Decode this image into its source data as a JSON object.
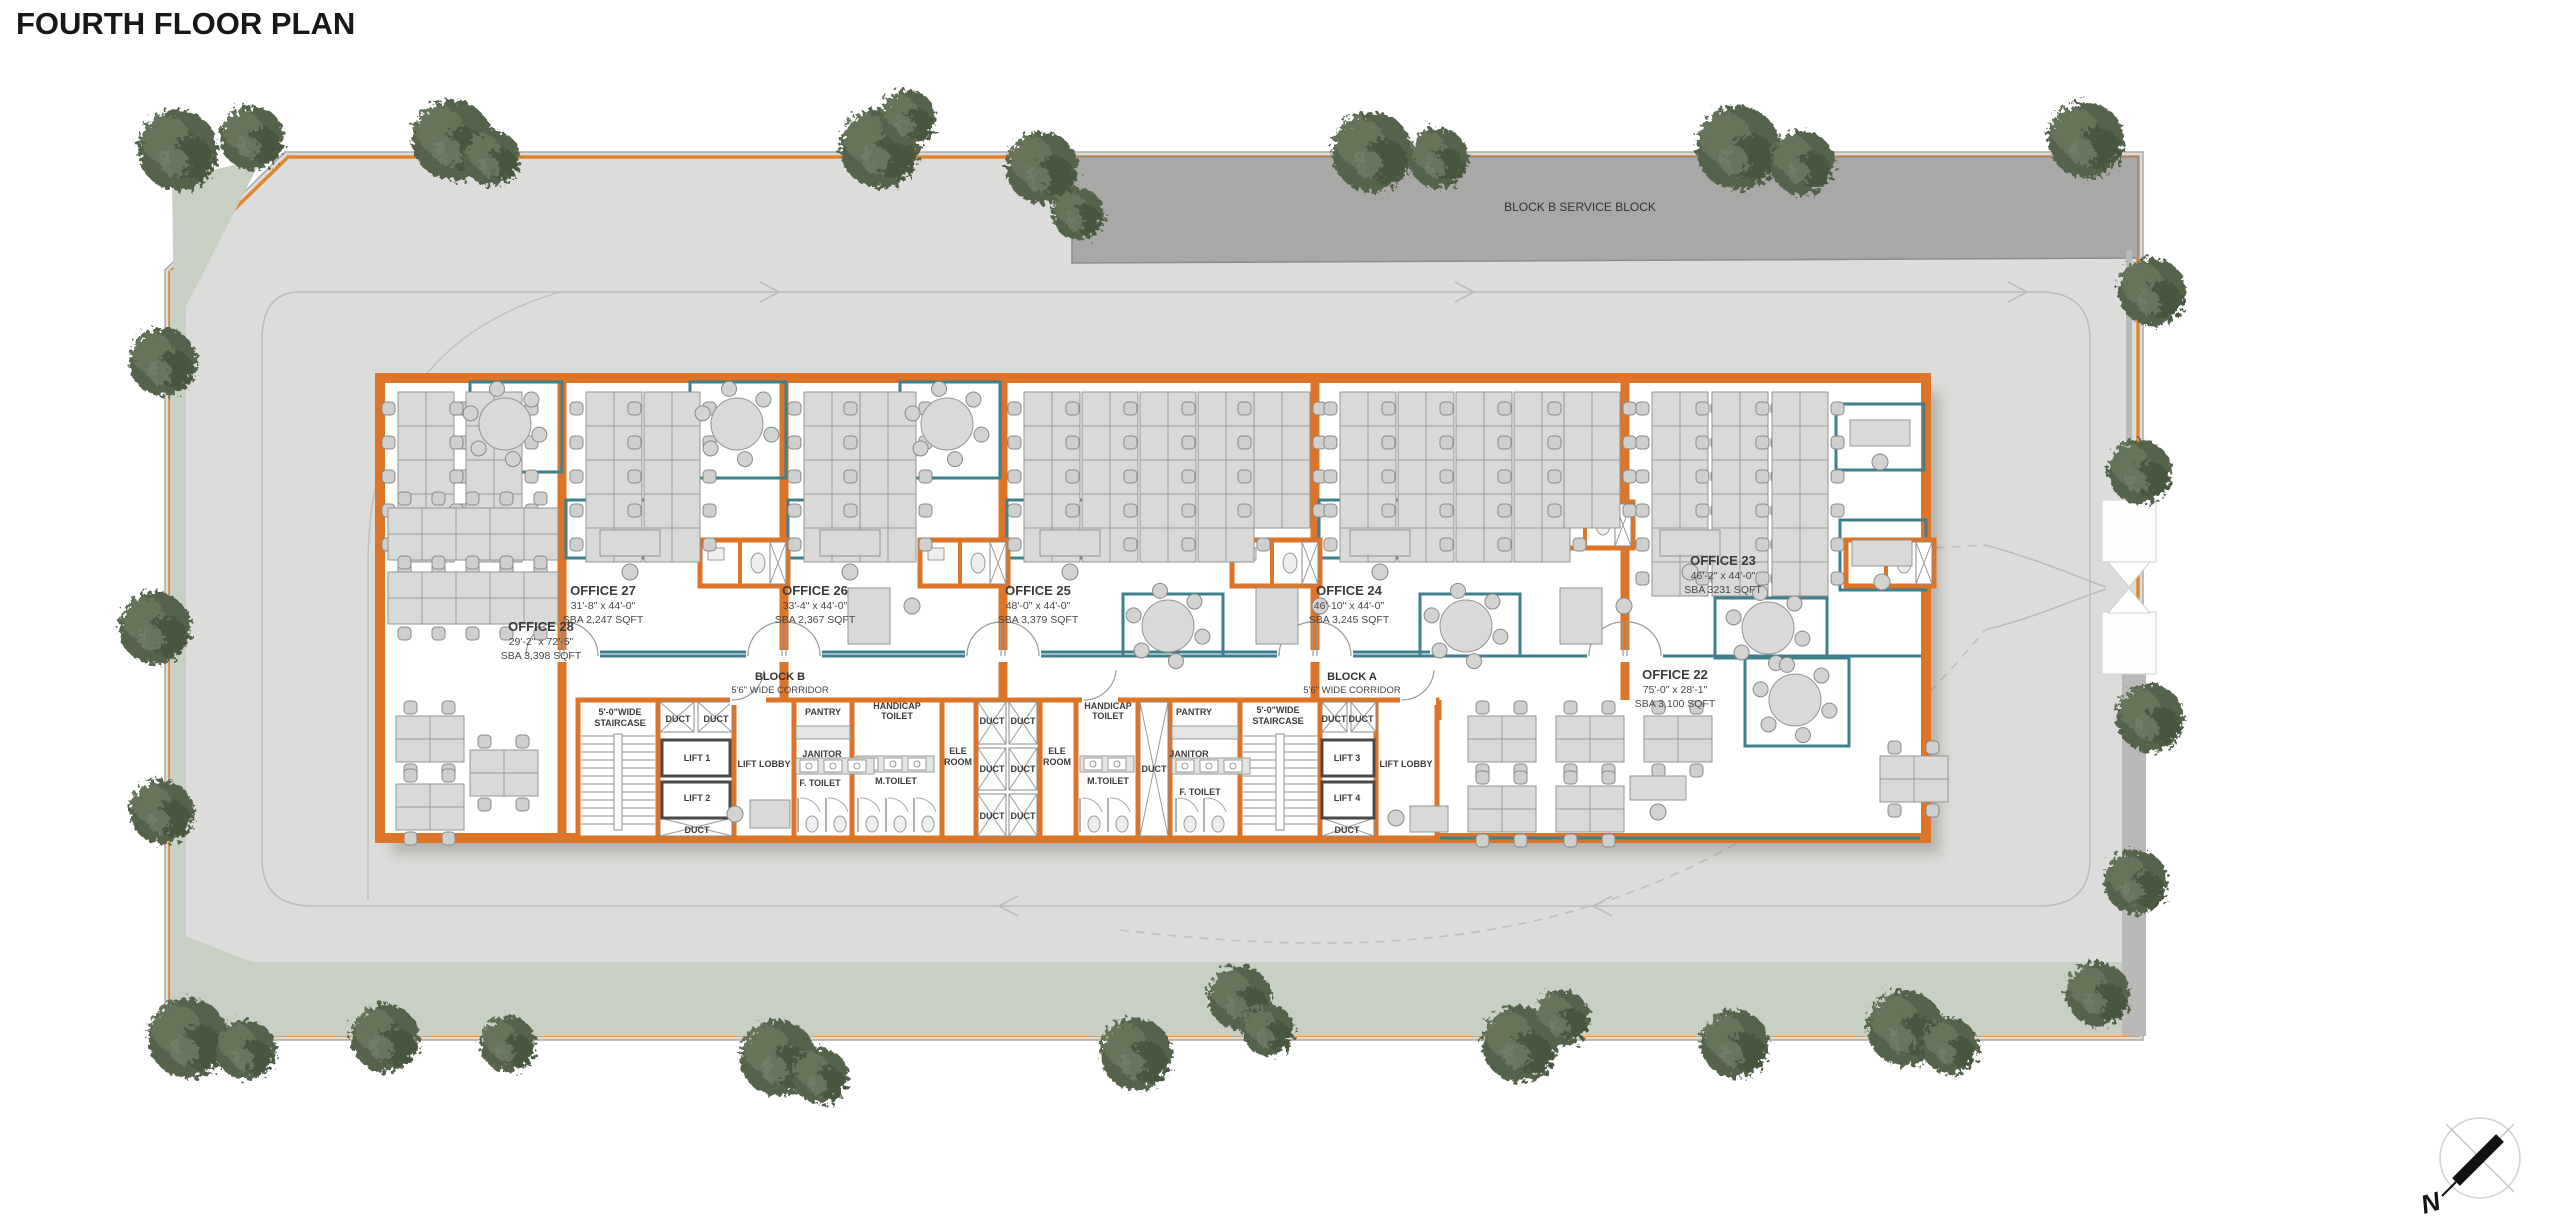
{
  "title": "FOURTH FLOOR PLAN",
  "site": {
    "service_block_label": "BLOCK B SERVICE BLOCK"
  },
  "compass": {
    "north_label": "N"
  },
  "building": {
    "corridors": [
      {
        "block": "BLOCK B",
        "width": "5'6\" WIDE CORRIDOR"
      },
      {
        "block": "BLOCK A",
        "width": "5'6\" WIDE CORRIDOR"
      }
    ],
    "offices": [
      {
        "name": "OFFICE 28",
        "dims": "29'-2\" x 72'-5\"",
        "area": "SBA 3,398 SQFT"
      },
      {
        "name": "OFFICE 27",
        "dims": "31'-8\" x 44'-0\"",
        "area": "SBA 2,247 SQFT"
      },
      {
        "name": "OFFICE 26",
        "dims": "33'-4\" x 44'-0\"",
        "area": "SBA 2,367 SQFT"
      },
      {
        "name": "OFFICE 25",
        "dims": "48'-0\" x 44'-0\"",
        "area": "SBA 3,379 SQFT"
      },
      {
        "name": "OFFICE 24",
        "dims": "46'-10\" x 44'-0\"",
        "area": "SBA 3,245 SQFT"
      },
      {
        "name": "OFFICE 23",
        "dims": "46'-2\" x 44'-0\"",
        "area": "SBA 3231 SQFT"
      },
      {
        "name": "OFFICE 22",
        "dims": "75'-0\" x 28'-1\"",
        "area": "SBA 3,100 SQFT"
      }
    ],
    "core": {
      "staircase_line1": "5'-0\"WIDE",
      "staircase_line2": "STAIRCASE",
      "duct": "DUCT",
      "lift1": "LIFT 1",
      "lift2": "LIFT 2",
      "lift3": "LIFT 3",
      "lift4": "LIFT 4",
      "lift_lobby": "LIFT LOBBY",
      "pantry": "PANTRY",
      "janitor": "JANITOR",
      "f_toilet": "F. TOILET",
      "m_toilet": "M.TOILET",
      "handicap_line1": "HANDICAP",
      "handicap_line2": "TOILET",
      "ele_line1": "ELE",
      "ele_line2": "ROOM"
    }
  },
  "colors": {
    "wall_orange": "#dd7428",
    "boundary_orange": "#e0862e",
    "partition_teal": "#3f7f8e",
    "ground_gray": "#dcdcda",
    "green_strip": "#c7d0c3",
    "service_gray": "#a8a8a6",
    "furniture_gray": "#d9d9d7"
  }
}
